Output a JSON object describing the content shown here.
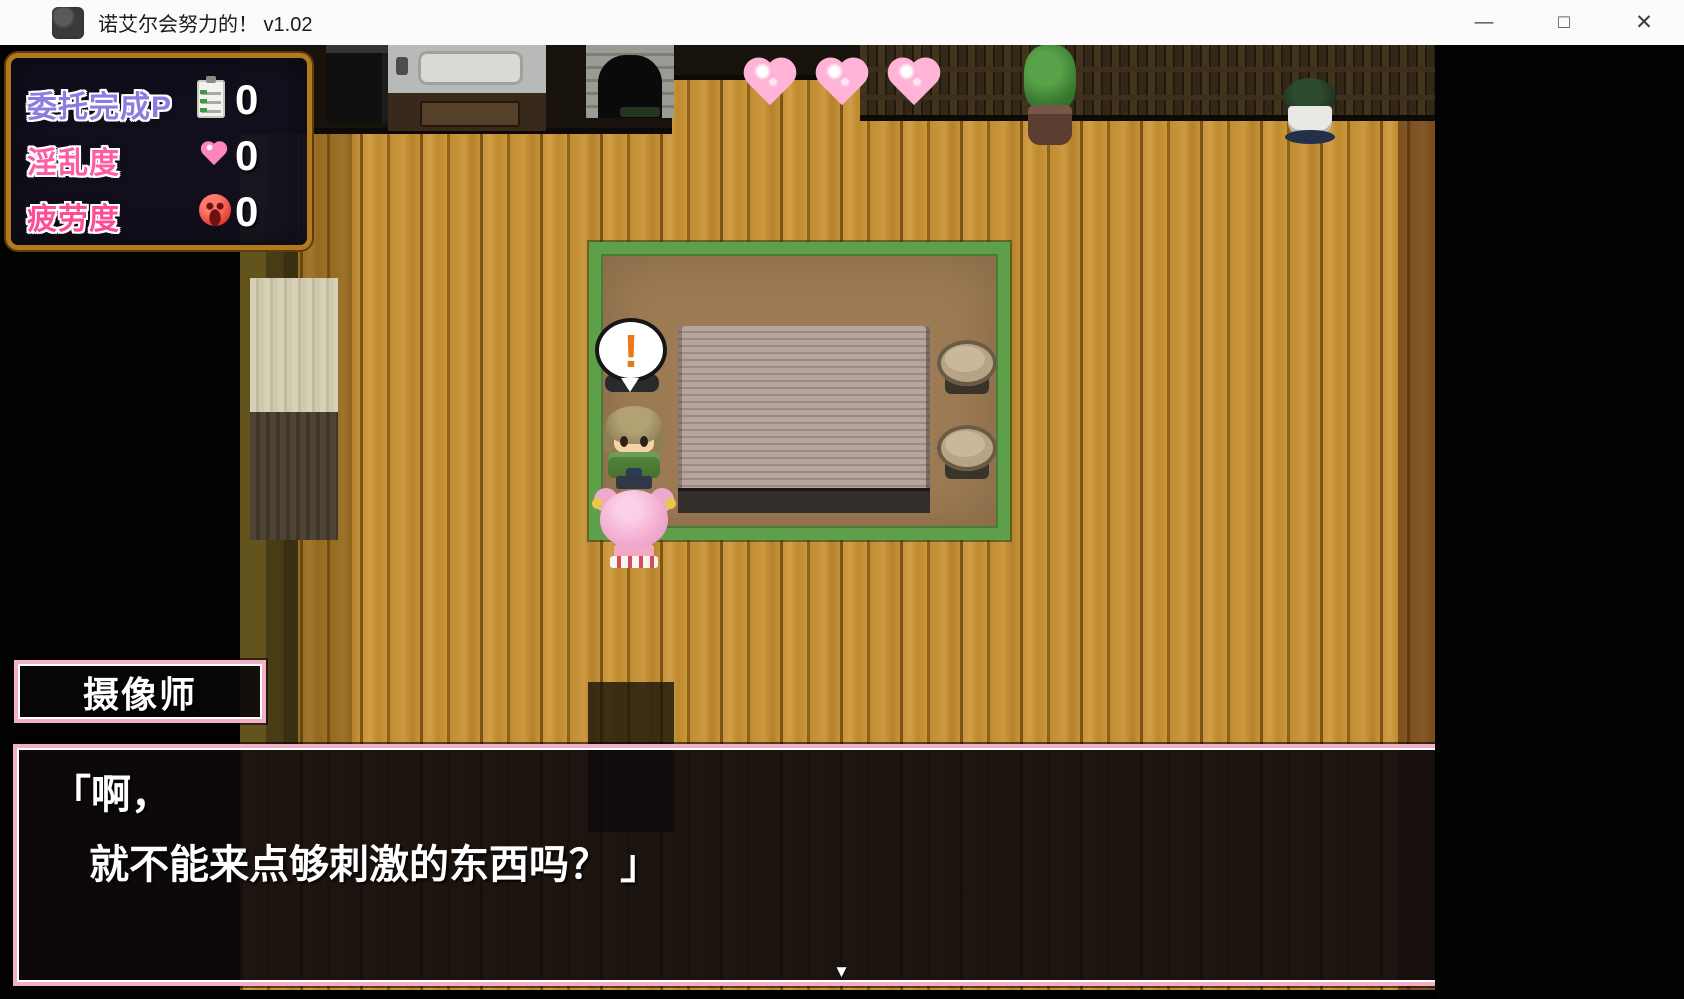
{
  "window": {
    "title": "诺艾尔会努力的！ v1.02",
    "controls": {
      "minimize": "—",
      "maximize": "□",
      "close": "✕"
    }
  },
  "hud": {
    "rows": [
      {
        "label": "委托完成P",
        "icon": "checklist-icon",
        "value": "0",
        "label_color": "#8b7ce0"
      },
      {
        "label": "淫乱度",
        "icon": "pink-heart-icon",
        "value": "0",
        "label_color": "#ff5ca4"
      },
      {
        "label": "疲劳度",
        "icon": "angry-face-icon",
        "value": "0",
        "label_color": "#ff4d94"
      }
    ]
  },
  "scene": {
    "exclamation": "!",
    "hearts_count": 3
  },
  "message": {
    "speaker": "摄像师",
    "lines": [
      "「啊，",
      "就不能来点够刺激的东西吗？ 」"
    ],
    "continue_indicator": "▼"
  },
  "colors": {
    "frame_pink": "#f2b0c8",
    "hud_border_orange": "#b3791f",
    "floor_wood": "#c08d33",
    "carpet_green_border": "#5e9f49",
    "carpet_brown": "#9d7c55",
    "heart_pink": "#ffb3d6",
    "exclamation_orange": "#e8791a"
  }
}
